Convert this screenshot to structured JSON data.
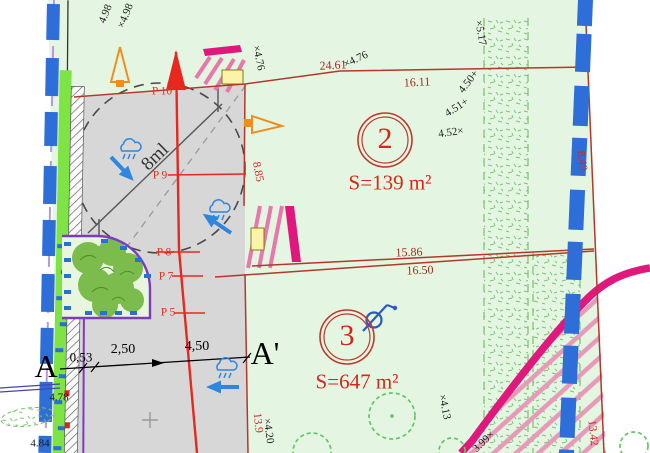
{
  "drawing_type": "cadastral site plan",
  "colors": {
    "parcel_green_bg": "#e4f6e2",
    "driveway_gray": "#d7d7d7",
    "boundary_red": "#b5372a",
    "section_line_red": "#e8281e",
    "label_red": "#d1281c",
    "road_magenta": "#e0187e",
    "boundary_blue_dash": "#2e6ed8",
    "hedge_green": "#7ee344",
    "orange_marker": "#ef8e1f",
    "purple_border": "#7d3bbd",
    "stair_yellow": "#fbf3a8"
  },
  "parcels": [
    {
      "number": "2",
      "area": "S=139 m²"
    },
    {
      "number": "3",
      "area": "S=647 m²"
    }
  ],
  "section": {
    "start": "A",
    "end": "A'",
    "segments": [
      "0,53",
      "2,50",
      "4,50"
    ]
  },
  "points": {
    "p10": "P 10",
    "p9": "P 9",
    "p8": "P 8",
    "p7": "P 7",
    "p5": "P 5"
  },
  "turning_circle": {
    "label": "8ml"
  },
  "dimensions": {
    "d2461": "24.61",
    "d1611": "16.11",
    "d885": "8.85",
    "d849": "8.49",
    "d1586": "15.86",
    "d1650": "16.50",
    "d139": "13.9",
    "d1342": "13.42"
  },
  "elevations": {
    "e498a": "4.98",
    "e498b": "×4.98",
    "e476a": "×4.76",
    "e476b": "×4.76",
    "e517": "×5.17",
    "e450": "4.50+",
    "e451": "4.51+",
    "e452": "4.52×",
    "e478": "4.78",
    "e484": "4.84",
    "e413": "×4.13",
    "e420": "×4.20",
    "e399": "3.99×"
  }
}
